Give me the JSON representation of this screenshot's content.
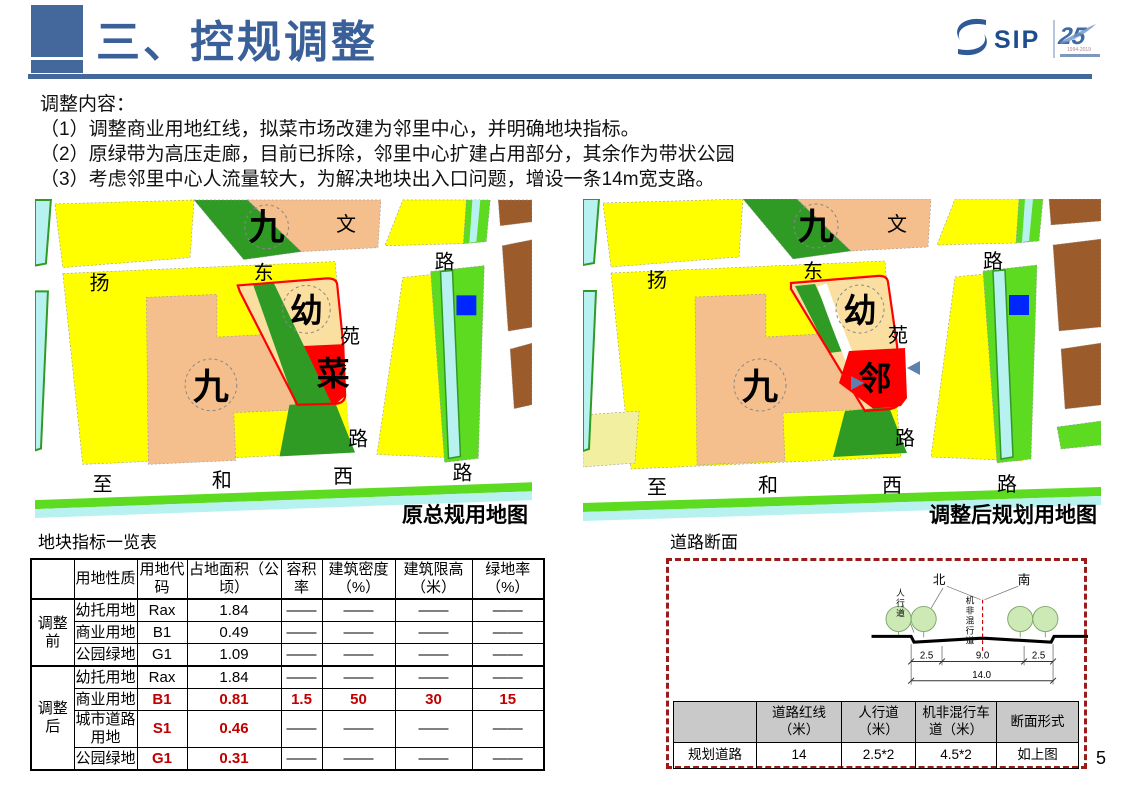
{
  "page": {
    "number": "5"
  },
  "header": {
    "title": "三、控规调整",
    "logo": {
      "sip": "SIP",
      "anniversary": "25",
      "years": "1994-2019"
    }
  },
  "intro": {
    "heading": "调整内容：",
    "items": [
      "（1）调整商业用地红线，拟菜市场改建为邻里中心，并明确地块指标。",
      "（2）原绿带为高压走廊，目前已拆除，邻里中心扩建占用部分，其余作为带状公园",
      "（3）考虑邻里中心人流量较大，为解决地块出入口问题，增设一条14m宽支路。"
    ]
  },
  "colors": {
    "accent_blue": "#45689C",
    "title_blue": "#3A5F99",
    "highlight_red": "#C00000",
    "map_yellow": "#FFFF00",
    "map_peach": "#F5BE8D",
    "map_tan": "#FADFA0",
    "map_red": "#FF0000",
    "map_dark_green": "#2F9B25",
    "map_bright_green": "#5CDB21",
    "map_cyan": "#B8F2F0",
    "map_brown": "#9B5B2A",
    "map_blue": "#0026FF",
    "map_pale_yellow": "#F2F0A0",
    "dashed_box_red": "#9B1B1B"
  },
  "maps": {
    "left": {
      "caption": "原总规用地图",
      "labels": [
        {
          "t": "九",
          "x": 233,
          "y": 40,
          "s": 36,
          "b": 1
        },
        {
          "t": "九",
          "x": 177,
          "y": 200,
          "s": 36,
          "b": 1
        },
        {
          "t": "幼",
          "x": 273,
          "y": 123,
          "s": 33,
          "b": 1
        },
        {
          "t": "菜",
          "x": 300,
          "y": 186,
          "s": 33,
          "b": 1
        },
        {
          "t": "扬",
          "x": 65,
          "y": 90,
          "s": 20
        },
        {
          "t": "东",
          "x": 230,
          "y": 80,
          "s": 20
        },
        {
          "t": "路",
          "x": 412,
          "y": 69,
          "s": 20
        },
        {
          "t": "文",
          "x": 313,
          "y": 31,
          "s": 20
        },
        {
          "t": "苑",
          "x": 317,
          "y": 144,
          "s": 20
        },
        {
          "t": "路",
          "x": 325,
          "y": 247,
          "s": 20
        },
        {
          "t": "至",
          "x": 68,
          "y": 293,
          "s": 20
        },
        {
          "t": "和",
          "x": 188,
          "y": 289,
          "s": 20
        },
        {
          "t": "西",
          "x": 310,
          "y": 285,
          "s": 20
        },
        {
          "t": "路",
          "x": 430,
          "y": 281,
          "s": 20
        }
      ]
    },
    "right": {
      "caption": "调整后规划用地图",
      "labels": [
        {
          "t": "九",
          "x": 233,
          "y": 40,
          "s": 36,
          "b": 1
        },
        {
          "t": "九",
          "x": 177,
          "y": 200,
          "s": 36,
          "b": 1
        },
        {
          "t": "幼",
          "x": 277,
          "y": 123,
          "s": 33,
          "b": 1
        },
        {
          "t": "邻",
          "x": 292,
          "y": 191,
          "s": 33,
          "b": 1
        },
        {
          "t": "扬",
          "x": 74,
          "y": 88,
          "s": 20
        },
        {
          "t": "东",
          "x": 230,
          "y": 79,
          "s": 20
        },
        {
          "t": "路",
          "x": 410,
          "y": 69,
          "s": 20
        },
        {
          "t": "文",
          "x": 314,
          "y": 32,
          "s": 20
        },
        {
          "t": "苑",
          "x": 315,
          "y": 143,
          "s": 20
        },
        {
          "t": "路",
          "x": 322,
          "y": 246,
          "s": 20
        },
        {
          "t": "至",
          "x": 74,
          "y": 295,
          "s": 20
        },
        {
          "t": "和",
          "x": 185,
          "y": 293,
          "s": 20
        },
        {
          "t": "西",
          "x": 309,
          "y": 293,
          "s": 20
        },
        {
          "t": "路",
          "x": 424,
          "y": 292,
          "s": 20
        }
      ]
    }
  },
  "indicator_table": {
    "title": "地块指标一览表",
    "columns": [
      "",
      "用地性质",
      "用地代\n码",
      "占地面积（公\n顷）",
      "容积\n率",
      "建筑密度\n（%）",
      "建筑限高\n（米）",
      "绿地率\n（%）"
    ],
    "groups": [
      {
        "label": "调整前",
        "rows": [
          {
            "cells": [
              "幼托用地",
              "Rax",
              "1.84",
              "——",
              "——",
              "——",
              "——"
            ],
            "red": []
          },
          {
            "cells": [
              "商业用地",
              "B1",
              "0.49",
              "——",
              "——",
              "——",
              "——"
            ],
            "red": []
          },
          {
            "cells": [
              "公园绿地",
              "G1",
              "1.09",
              "——",
              "——",
              "——",
              "——"
            ],
            "red": []
          }
        ]
      },
      {
        "label": "调整后",
        "rows": [
          {
            "cells": [
              "幼托用地",
              "Rax",
              "1.84",
              "——",
              "——",
              "——",
              "——"
            ],
            "red": []
          },
          {
            "cells": [
              "商业用地",
              "B1",
              "0.81",
              "1.5",
              "50",
              "30",
              "15"
            ],
            "red": [
              1,
              2,
              3,
              4,
              5,
              6
            ]
          },
          {
            "cells": [
              "城市道路用地",
              "S1",
              "0.46",
              "——",
              "——",
              "——",
              "——"
            ],
            "red": [
              1,
              2
            ]
          },
          {
            "cells": [
              "公园绿地",
              "G1",
              "0.31",
              "——",
              "——",
              "——",
              "——"
            ],
            "red": [
              1,
              2
            ]
          }
        ]
      }
    ]
  },
  "road_section": {
    "title": "道路断面",
    "diagram": {
      "labels": [
        {
          "t": "北",
          "x": 84,
          "y": 22,
          "s": 13
        },
        {
          "t": "南",
          "x": 172,
          "y": 22,
          "s": 13
        },
        {
          "t": "人行道",
          "x": 44,
          "y": 34,
          "s": 9,
          "v": 1
        },
        {
          "t": "机非混行道",
          "x": 116,
          "y": 42,
          "s": 9,
          "v": 1
        },
        {
          "t": "2.5",
          "x": 71,
          "y": 99,
          "s": 10
        },
        {
          "t": "9.0",
          "x": 129,
          "y": 99,
          "s": 10
        },
        {
          "t": "2.5",
          "x": 187,
          "y": 99,
          "s": 10
        },
        {
          "t": "14.0",
          "x": 128,
          "y": 119,
          "s": 10
        }
      ]
    },
    "table": {
      "columns": [
        "",
        "道路红线\n（米）",
        "人行道\n（米）",
        "机非混行车\n道（米）",
        "断面形式"
      ],
      "rows": [
        [
          "规划道路",
          "14",
          "2.5*2",
          "4.5*2",
          "如上图"
        ]
      ]
    }
  }
}
